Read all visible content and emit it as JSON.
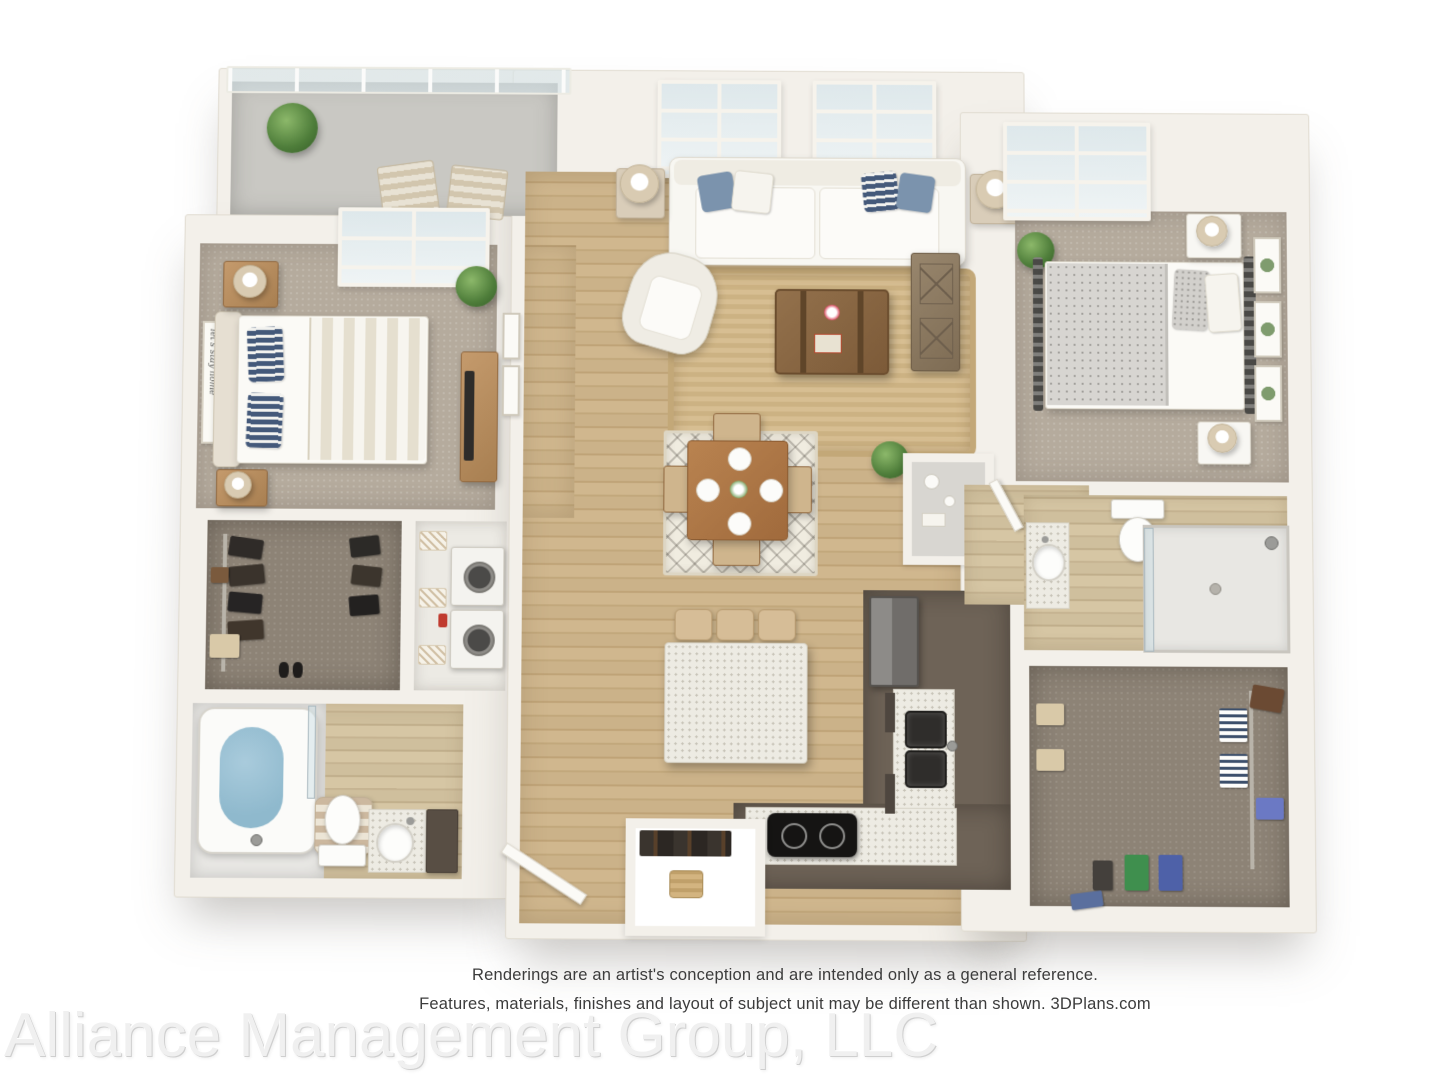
{
  "disclaimer": {
    "line1": "Renderings are an artist's conception and are intended only as a general reference.",
    "line2": "Features, materials, finishes and layout of subject unit may be different than shown. 3DPlans.com"
  },
  "watermark": {
    "text": "Alliance Management Group, LLC"
  },
  "bedroom_sign": {
    "text": "let's stay home"
  },
  "colors": {
    "wall": "#f3f0ea",
    "hardwood": "#c8ae84",
    "carpet": "#b5ab9d",
    "closet_carpet": "#8d8376",
    "kitchen_cabinet": "#6e6357",
    "counter_speckle": "#edebe3",
    "accent_pillow_blue": "#7b93ad",
    "accent_pillow_navy": "#44597a",
    "tub_water": "#8fb9cd",
    "jute_rug": "#d5bc90",
    "disclaimer_text": "#3c3c3c",
    "watermark_gray": "#f0f0f0"
  }
}
